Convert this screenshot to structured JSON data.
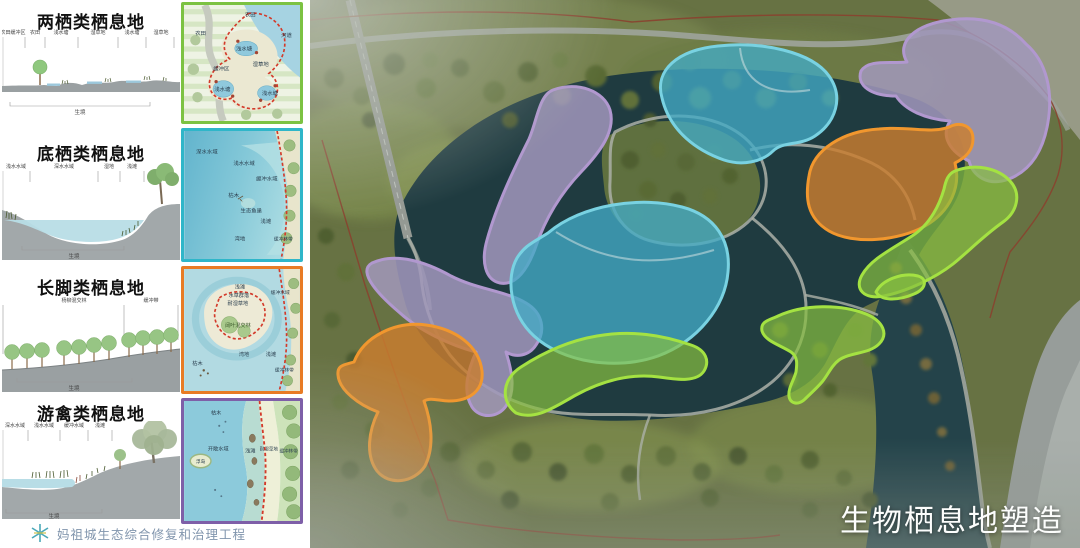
{
  "slide": {
    "map_title": "生物栖息地塑造",
    "project_name": "妈祖城生态综合修复和治理工程"
  },
  "sections": [
    {
      "title": "两栖类栖息地",
      "accent": "#7cc242",
      "base_label": "生境",
      "dim_labels": [
        "农田缓冲区",
        "农田",
        "浅水塘",
        "湿草地",
        "浅水塘",
        "湿草地"
      ],
      "plan_labels": [
        "农田",
        "农田",
        "河道",
        "浅水塘",
        "湿草地",
        "缓冲区",
        "浅水塘",
        "浅水塘"
      ]
    },
    {
      "title": "底栖类栖息地",
      "accent": "#2fb6c9",
      "base_label": "生境",
      "dim_labels": [
        "浅水水域",
        "深水水域",
        "湿地",
        "浅滩"
      ],
      "plan_labels": [
        "深水水域",
        "浅水水域",
        "缓冲水域",
        "枯木",
        "生态鱼巢",
        "浅滩",
        "湾地",
        "缓冲林带"
      ]
    },
    {
      "title": "长脚类栖息地",
      "accent": "#e87b25",
      "base_label": "生境",
      "dim_labels": [
        "杨柳混交林",
        "缓冲带"
      ],
      "plan_labels": [
        "浅滩",
        "水草群落",
        "耐湿草地",
        "阔叶混交林",
        "湾地",
        "浅滩",
        "缓冲水域",
        "缓冲林带",
        "枯木"
      ]
    },
    {
      "title": "游禽类栖息地",
      "accent": "#7e5fa8",
      "base_label": "生境",
      "dim_labels": [
        "深水水域",
        "浅水水域",
        "缓冲水域",
        "浅滩"
      ],
      "plan_labels": [
        "枯木",
        "开敞水域",
        "浮岛",
        "浅滩",
        "耐湿草地",
        "缓冲林带"
      ]
    }
  ],
  "map": {
    "habitat_palette": {
      "amphibian": {
        "fill": "rgba(138,200,60,0.70)",
        "stroke": "#aaee3e"
      },
      "benthic": {
        "fill": "rgba(62,176,208,0.78)",
        "stroke": "#7adcf0"
      },
      "wader": {
        "fill": "rgba(212,126,40,0.82)",
        "stroke": "#ff9a28"
      },
      "waterfowl": {
        "fill": "rgba(167,155,198,0.85)",
        "stroke": "#b89bdb"
      }
    }
  }
}
